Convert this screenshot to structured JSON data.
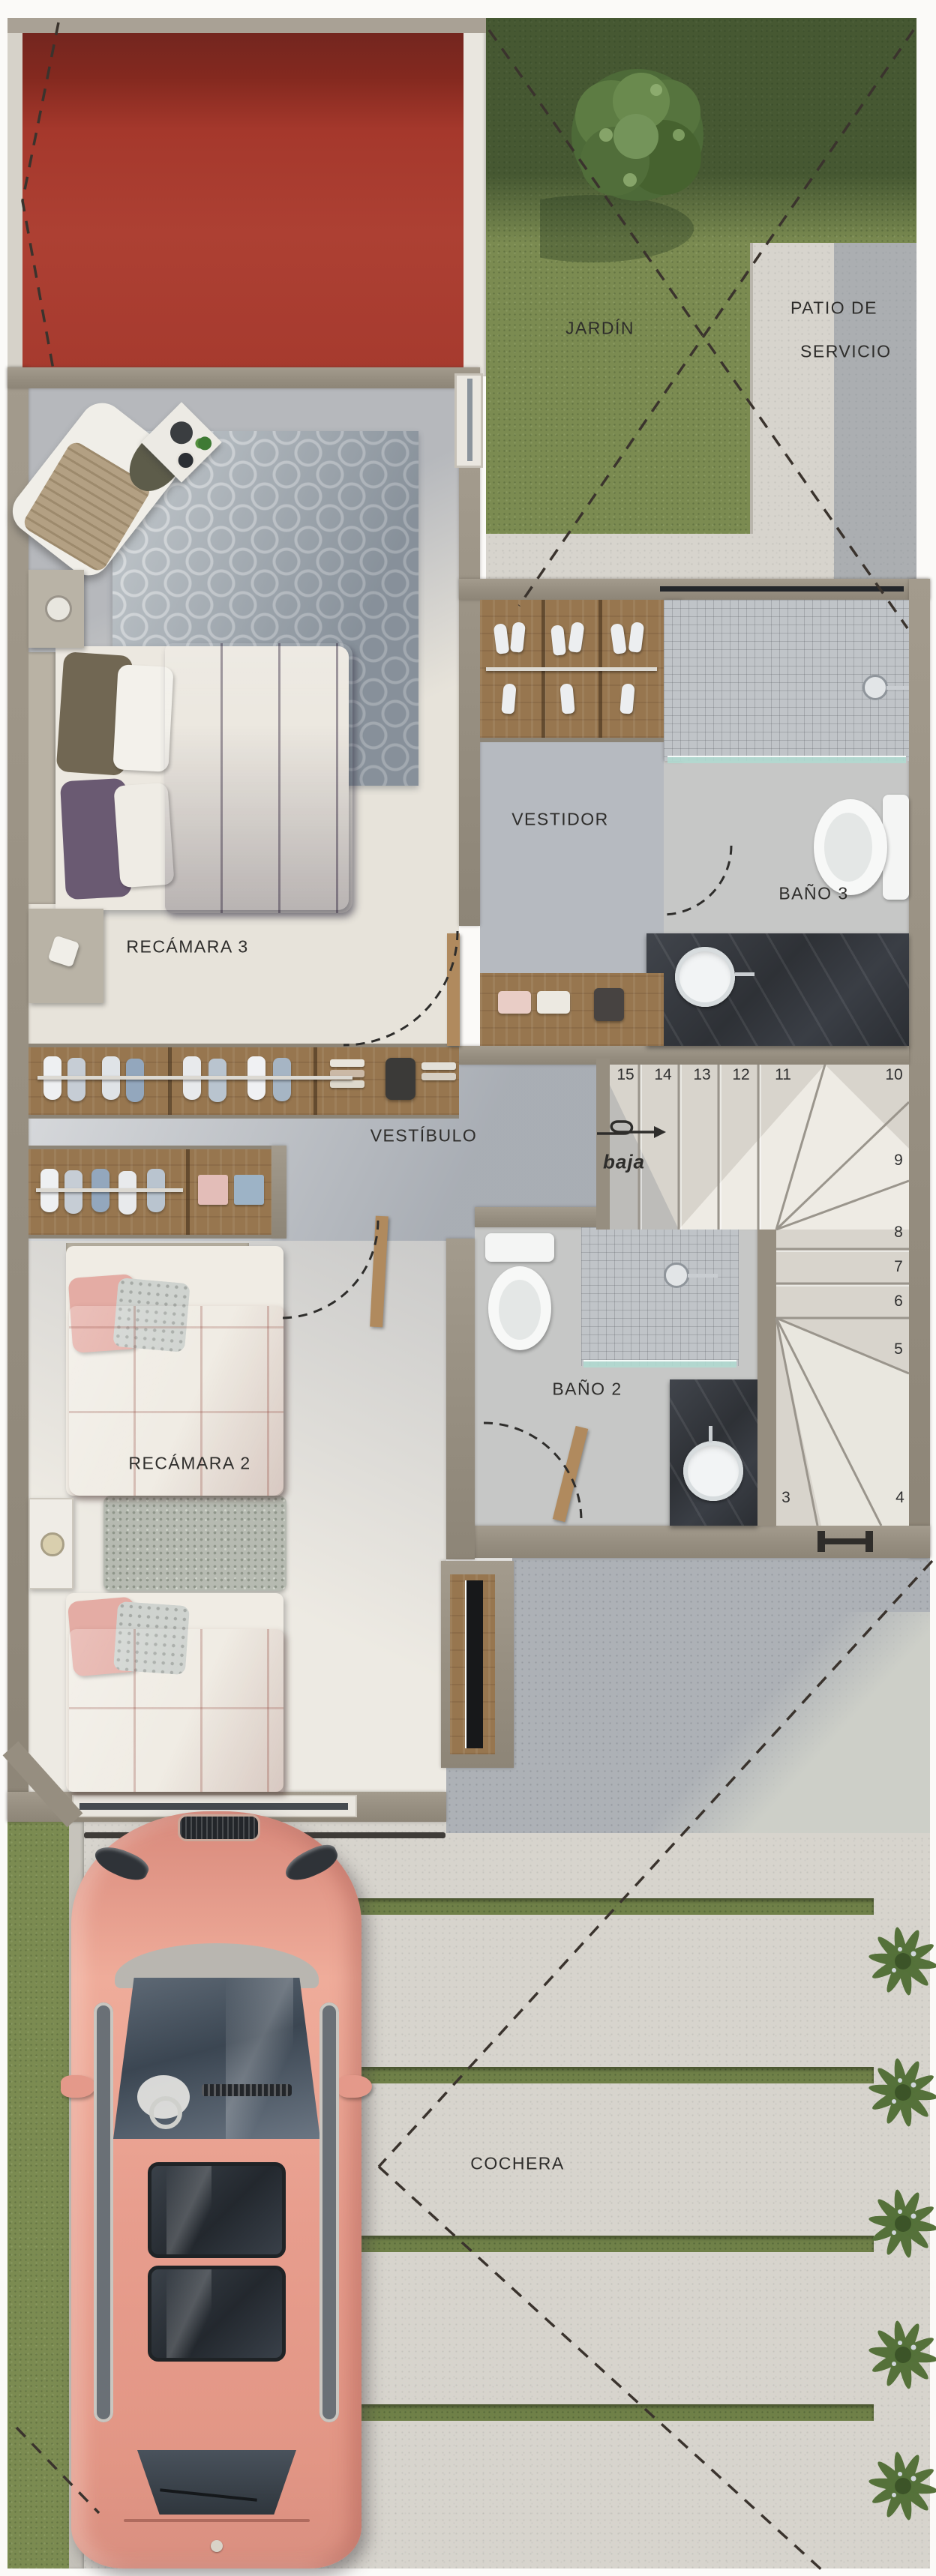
{
  "floor_plan": {
    "outdoor": {
      "garden_label": "JARDÍN",
      "service_patio_line1": "PATIO DE",
      "service_patio_line2": "SERVICIO",
      "garage_label": "COCHERA"
    },
    "rooms": {
      "bedroom3_label": "RECÁMARA 3",
      "walkin_closet_label": "VESTIDOR",
      "bath3_label": "BAÑO 3",
      "hall_label": "VESTÍBULO",
      "bath2_label": "BAÑO 2",
      "bedroom2_label": "RECÁMARA 2"
    },
    "stairs": {
      "direction_label": "baja",
      "steps": [
        "15",
        "14",
        "13",
        "12",
        "11",
        "10",
        "9",
        "8",
        "7",
        "6",
        "5",
        "4",
        "3"
      ]
    },
    "colors": {
      "roof_red": "#a63a2e",
      "grass_green": "#7b8b51",
      "wall_taupe": "#968e80",
      "car_salmon": "#e79d8d",
      "bed_purple": "#6e5b79",
      "bed_pink": "#e3b1a9",
      "concrete_light": "#d7d4cd",
      "concrete_shadow": "#adb1b6"
    }
  }
}
